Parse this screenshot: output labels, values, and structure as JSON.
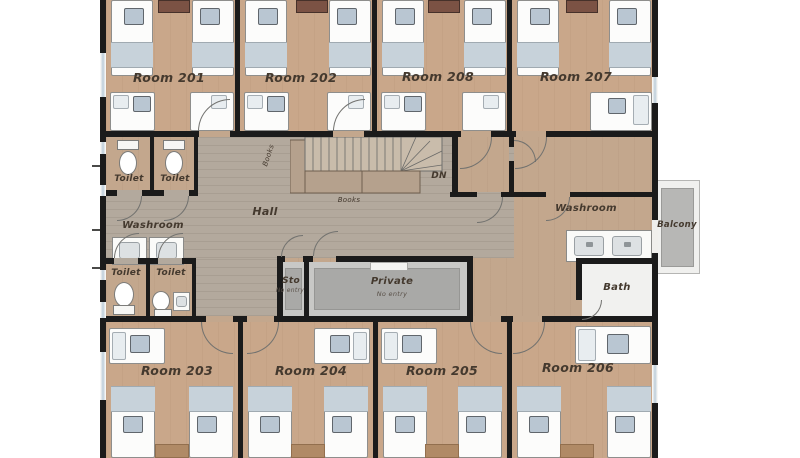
{
  "plan": {
    "type": "floor-plan",
    "labels": {
      "room201": "Room 201",
      "room202": "Room 202",
      "room208": "Room 208",
      "room207": "Room 207",
      "room203": "Room 203",
      "room204": "Room 204",
      "room205": "Room 205",
      "room206": "Room 206",
      "toilet": "Toilet",
      "washroom": "Washroom",
      "hall": "Hall",
      "books": "Books",
      "down": "DN",
      "balcony": "Balcony",
      "bath": "Bath",
      "storage": "Sto",
      "private": "Private",
      "no_entry": "No entry"
    },
    "colors": {
      "wall": "#1b1b1b",
      "room_floor": "#c9a78a",
      "hall_floor": "#b3a99d",
      "bed": "#fcfcfb",
      "blanket": "#c7d2da",
      "nightstand": "#b9c6d2",
      "desk": "#7b5244",
      "private_floor": "#a9a9a7",
      "balcony_floor": "#b7b7b5",
      "window_glass": "#c9d6df"
    }
  }
}
